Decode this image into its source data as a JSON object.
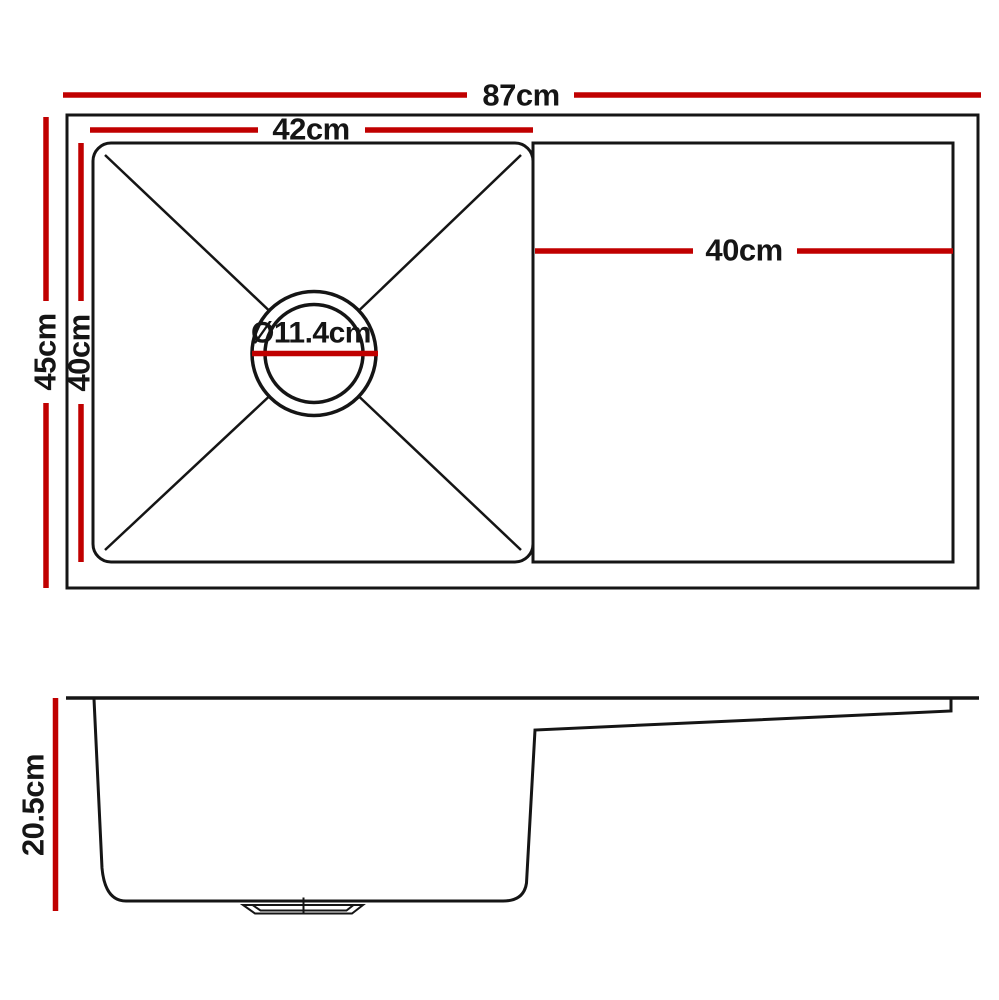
{
  "diagram": {
    "kind": "kitchen-sink-dimension-drawing",
    "views": {
      "top_view": {
        "dimensions": {
          "overall_width": "87cm",
          "bowl_width": "42cm",
          "drainer_width": "40cm",
          "overall_depth": "45cm",
          "bowl_depth": "40cm",
          "drain_diameter": "Ø11.4cm"
        }
      },
      "side_view": {
        "dimensions": {
          "bowl_height": "20.5cm"
        }
      }
    }
  },
  "colors": {
    "dimension_red": "#c00000",
    "line_black": "#151515",
    "background": "#ffffff"
  }
}
